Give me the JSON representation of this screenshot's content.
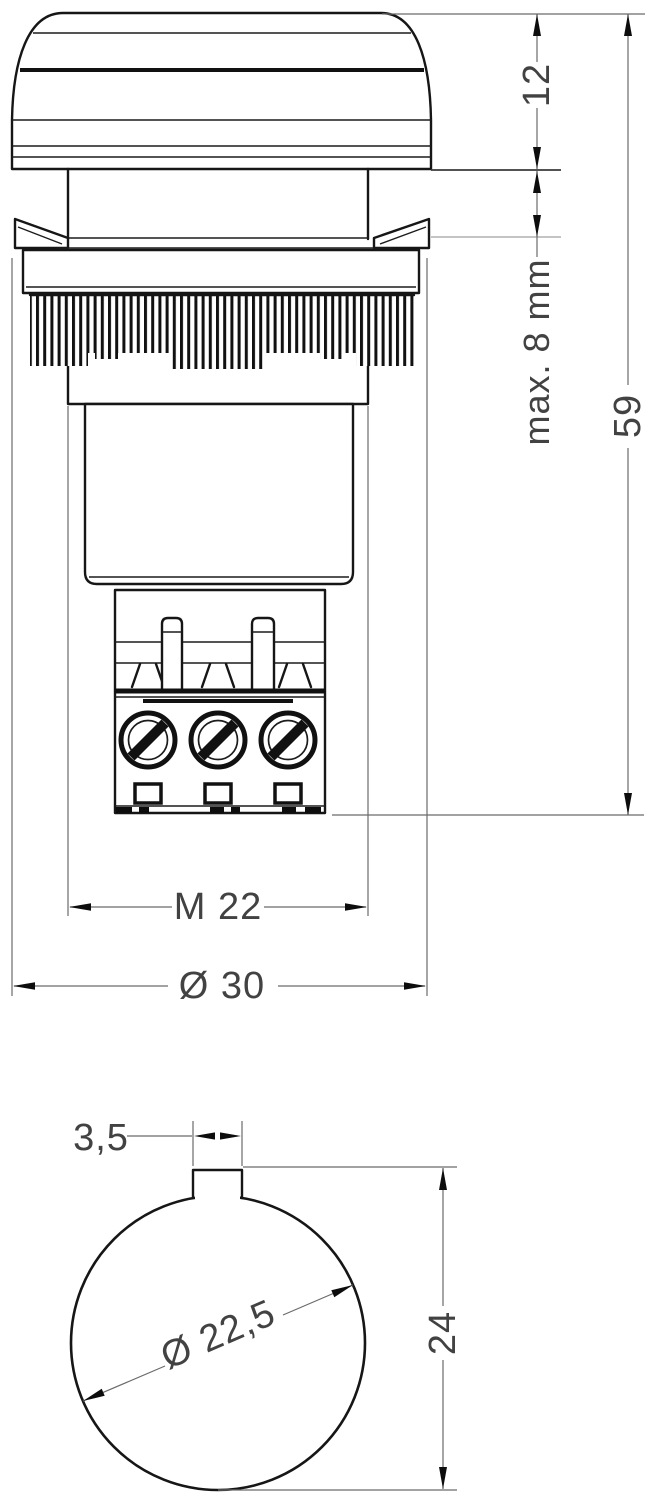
{
  "page": {
    "background": "#ffffff"
  },
  "side_view": {
    "dims": {
      "lens_height": {
        "label": "12",
        "orientation": "vertical"
      },
      "panel_thickness": {
        "label": "max. 8 mm",
        "orientation": "vertical"
      },
      "total_height": {
        "label": "59",
        "orientation": "vertical"
      },
      "thread": {
        "label": "M 22",
        "orientation": "horizontal"
      },
      "flange_diameter": {
        "label": "Ø 30",
        "orientation": "horizontal"
      }
    }
  },
  "bottom_view": {
    "dims": {
      "tab_width": {
        "label": "3,5"
      },
      "hole_diameter": {
        "label": "Ø 22,5"
      },
      "hole_height": {
        "label": "24"
      }
    }
  },
  "colors": {
    "outline": "#161616",
    "dim_line": "#6b6b6b",
    "text": "#424242",
    "background": "#ffffff"
  }
}
